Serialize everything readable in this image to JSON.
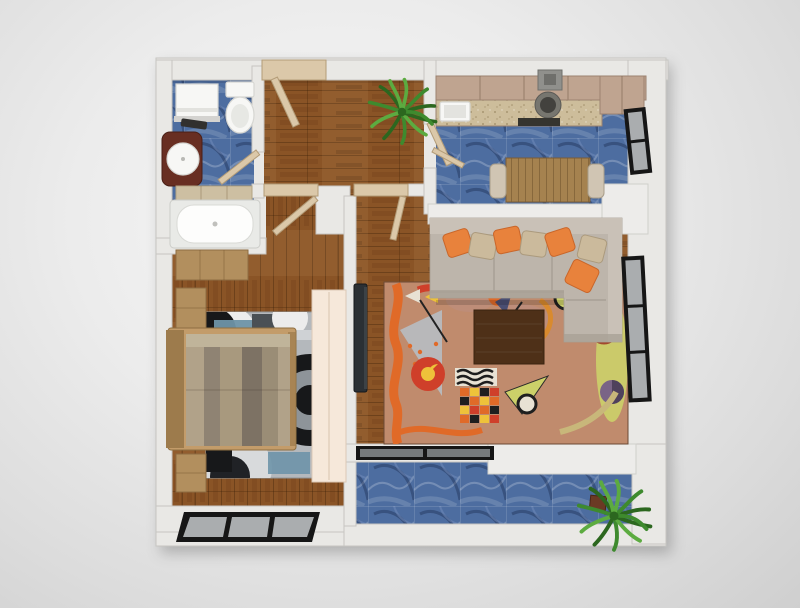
{
  "scene": {
    "title": "apartment-floor-plan-top-view",
    "style": "3d-rendered-top-down-floorplan",
    "background": "#e3e3e3"
  },
  "rooms": [
    {
      "id": "bathroom",
      "floor": "blue-marble-tile",
      "furniture": [
        "washing-machine",
        "bath-mat",
        "toilet",
        "vanity-with-round-sink",
        "towel-shelf",
        "bathtub"
      ]
    },
    {
      "id": "entry-hall",
      "floor": "hardwood",
      "furniture": [
        "entry-door",
        "potted-plant"
      ]
    },
    {
      "id": "kitchen",
      "floor": "blue-marble-tile",
      "furniture": [
        "upper-cabinets",
        "range-hood",
        "cooktop",
        "oven",
        "countertop",
        "kitchen-sink",
        "tall-cabinet",
        "dining-table",
        "dining-chair-left",
        "dining-chair-right",
        "half-wall-counter"
      ]
    },
    {
      "id": "living-room",
      "floor": "hardwood",
      "furniture": [
        "l-shaped-sectional-sofa",
        "throw-pillows-orange",
        "throw-pillows-tan",
        "abstract-area-rug",
        "coffee-table",
        "wall-mounted-tv",
        "sliding-balcony-door"
      ]
    },
    {
      "id": "bedroom",
      "floor": "hardwood",
      "furniture": [
        "double-bed-striped-bedding",
        "nightstand-upper",
        "nightstand-lower",
        "dresser",
        "geometric-circle-rug",
        "wardrobe-panel",
        "bedroom-window"
      ]
    },
    {
      "id": "balcony",
      "floor": "blue-marble-tile",
      "furniture": [
        "potted-plant",
        "marble-ledge"
      ]
    }
  ],
  "openings": {
    "doors": [
      "entry-door",
      "bathroom-door",
      "bedroom-door",
      "living-room-door",
      "kitchen-door"
    ],
    "windows": [
      "kitchen-window",
      "living-room-window",
      "bedroom-window",
      "sliding-balcony-door"
    ]
  },
  "palette": {
    "wall": "#e9e8e5",
    "wallEdge": "#c6c5c1",
    "wood": "#8a5426",
    "woodDark": "#6e4119",
    "tile": "#4d6da0",
    "door": "#dbc8a9",
    "doorEdge": "#b39c78",
    "cabinet": "#bfa490",
    "cabinetDark": "#9c8270",
    "counter": "#cdbd9b",
    "hood": "#90908c",
    "appliance": "#35342f",
    "marble": "#edecea",
    "tableWood": "#a5824f",
    "tableWoodDark": "#7a5c36",
    "chair": "#d0c5b3",
    "sofa": "#bdb5ab",
    "sofaLight": "#c9c1b7",
    "sofaDark": "#a9a196",
    "pillowOrange": "#e8823c",
    "pillowTan": "#cbba9c",
    "rugBase": "#c08b6d",
    "rugOrange": "#e06a28",
    "rugRed": "#cf3f2a",
    "rugYellow": "#eec23a",
    "rugChartreuse": "#ccd069",
    "rugGray": "#b7bcc2",
    "rugNavy": "#4a4e72",
    "rugPurple": "#7a6486",
    "rugBlack": "#1f1f1f",
    "rugCream": "#e8e2d4",
    "rugMauve": "#bb8f83",
    "coffeeTable": "#4e3018",
    "tv": "#2b3034",
    "wardrobe": "#f6e8da",
    "bedFrame": "#c39c6a",
    "bedFrameDark": "#9d7b4c",
    "woodFurn": "#b28f5e",
    "bedding1": "#b1a289",
    "bedding2": "#8f8373",
    "bedding3": "#a8997e",
    "bedding4": "#7d7264",
    "bedding5": "#9a8d76",
    "beddingTop": "#c0b49a",
    "bedroomRug": "#b4b8bc",
    "brBlack": "#17181a",
    "brGray": "#8e9499",
    "brWhite": "#ececec",
    "brBlue": "#6e93a8",
    "brSteel": "#4a5055",
    "fixture": "#f7f7f5",
    "fixtureEdge": "#d6d6d2",
    "vanity": "#682e22",
    "windowFrame": "#161616",
    "windowPane": "#aaadaf",
    "plant": "#3e8a2e",
    "plantDark": "#2c671f",
    "plantLight": "#5cab40",
    "pot": "#6b3a24"
  }
}
